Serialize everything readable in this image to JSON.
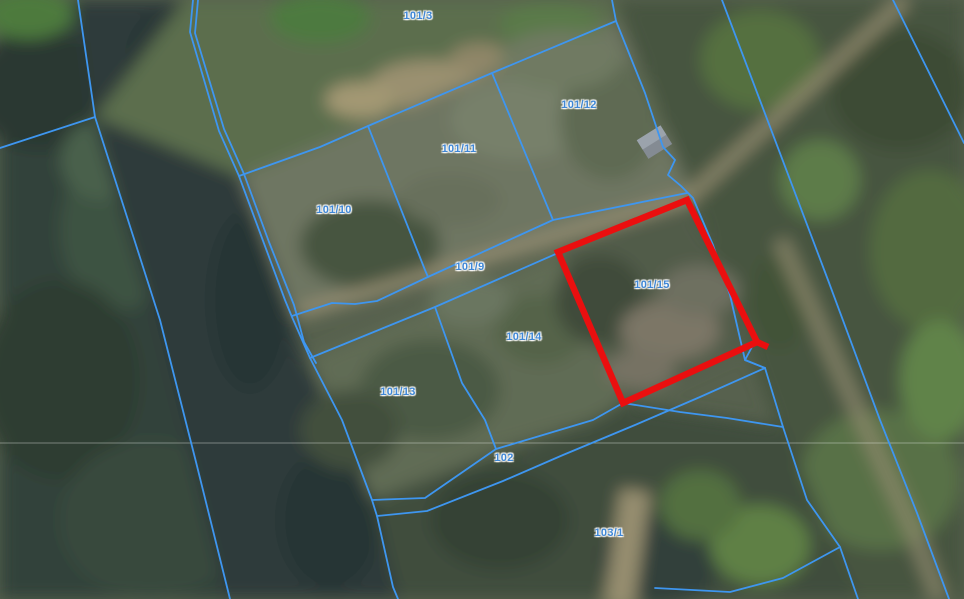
{
  "map": {
    "type": "cadastral-parcel-map-over-aerial-imagery",
    "highlighted_parcel": "101/15",
    "colors": {
      "boundary_blue": "#3e96f0",
      "highlight_red": "#ea0f0f",
      "label_blue": "#3f87d6"
    },
    "labels": [
      {
        "text": "101/3",
        "x": 418,
        "y": 16
      },
      {
        "text": "101/12",
        "x": 579,
        "y": 105
      },
      {
        "text": "101/11",
        "x": 459,
        "y": 149
      },
      {
        "text": "101/10",
        "x": 334,
        "y": 210
      },
      {
        "text": "101/9",
        "x": 470,
        "y": 267
      },
      {
        "text": "101/15",
        "x": 652,
        "y": 285
      },
      {
        "text": "101/14",
        "x": 524,
        "y": 337
      },
      {
        "text": "101/13",
        "x": 398,
        "y": 392
      },
      {
        "text": "102",
        "x": 504,
        "y": 458
      },
      {
        "text": "103/1",
        "x": 609,
        "y": 533
      }
    ]
  }
}
